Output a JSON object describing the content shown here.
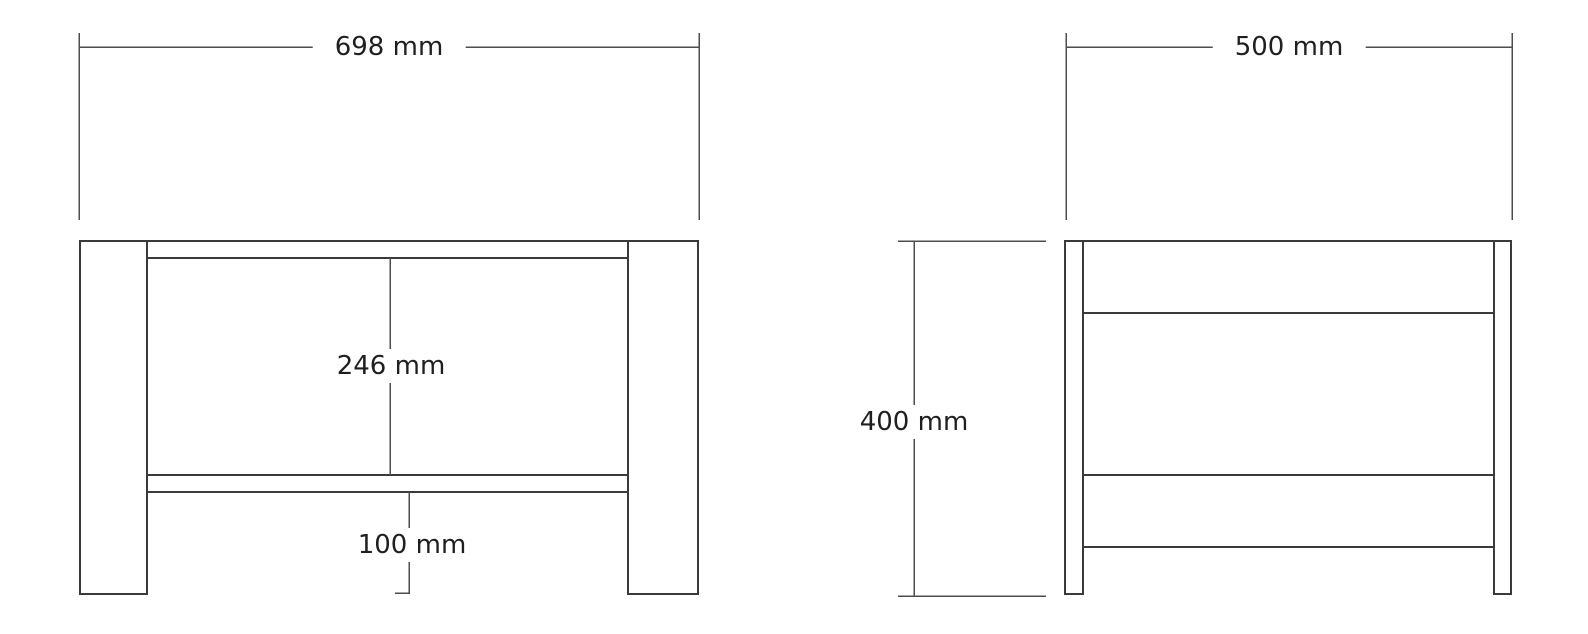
{
  "colors": {
    "background": "#ffffff",
    "object_line": "#3a3a3a",
    "dimension_line": "#4d4d4d",
    "text": "#1f1f1f"
  },
  "dimensions": {
    "front_width": "698 mm",
    "side_depth": "500 mm",
    "front_interior_height": "246 mm",
    "side_height": "400 mm",
    "front_bottom_clearance": "100 mm"
  }
}
